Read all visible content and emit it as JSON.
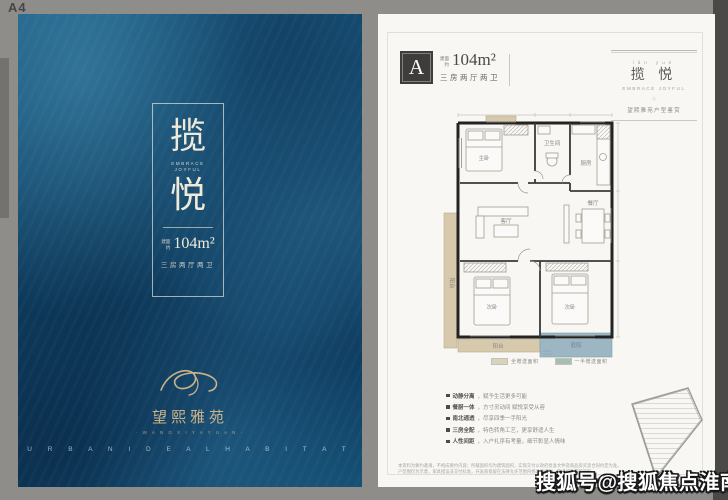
{
  "page_label": "A4",
  "watermark": "搜狐号@搜狐焦点淮南站",
  "colors": {
    "cover_base": "#12486d",
    "cover_text": "#f0ead9",
    "gold": "#c9b48b",
    "page_bg": "#f8f7f4",
    "badge_bg": "#3e3d3b",
    "wall": "#232323",
    "balcony_tan": "#d7c9ac",
    "patio_teal": "#9cb6c4",
    "legend_green": "#a6c0ad"
  },
  "cover": {
    "title_char_1": "揽",
    "title_char_2": "悦",
    "title_en_line1": "EMBRACE",
    "title_en_line2": "JOYFUL",
    "area_prefix_l1": "建面",
    "area_prefix_l2": "约",
    "area_value": "104m²",
    "layout_text": "三房两厅两卫",
    "logo_name": "望熙雅苑",
    "logo_sub": "· W A N G X I  Y A Y U A N ·",
    "footer_en": "U R B A N  I D E A L  H A B I T A T"
  },
  "plan_page": {
    "unit_label": "A",
    "area_prefix_l1": "建面",
    "area_prefix_l2": "约",
    "area_value": "104m²",
    "layout_text": "三房两厅两卫",
    "masthead": {
      "tiny_top": "lǎn yuè",
      "title": "揽 悦",
      "subtitle": "EMBRACE JOYFUL",
      "diamond": "◇",
      "tagline": "望熙雅苑户型鉴赏"
    },
    "floorplan": {
      "rooms": {
        "master": "主卧",
        "bath": "卫生间",
        "kitchen": "厨房",
        "living": "客厅",
        "dining": "餐厅",
        "bedroom2": "次卧",
        "bedroom3": "次卧",
        "balcony_side": "阳台",
        "balcony_bottom": "阳台",
        "patio": "庭院"
      }
    },
    "legend": [
      {
        "label": "全赠送面积",
        "color": "#d9d3bc"
      },
      {
        "label": "一半赠送面积",
        "color": "#a6c0ad"
      }
    ],
    "features": [
      {
        "prefix": "动静分离",
        "text": "，赋予生活更多可能"
      },
      {
        "prefix": "餐厨一体",
        "text": "，方寸灵动间 赋悦享受从容"
      },
      {
        "prefix": "南北通透",
        "text": "，尽享四季一手阳光"
      },
      {
        "prefix": "三房全配",
        "text": "，特色转角工艺，更享舒适人生"
      },
      {
        "prefix": "人性间距",
        "text": "，入户礼序有考量，细节彰显人情味"
      }
    ],
    "disclaimer_l1": "本资料为要约邀请，不构成要约内容；所载面积均为建筑面积，实际交付以政府批准文件及商品房买卖合同约定为准。",
    "disclaimer_l2": "户型图仅为示意，家具摆设非交付标准，开发商保留在法律允许范围内修改的权利，敬请留意最新资料。"
  }
}
